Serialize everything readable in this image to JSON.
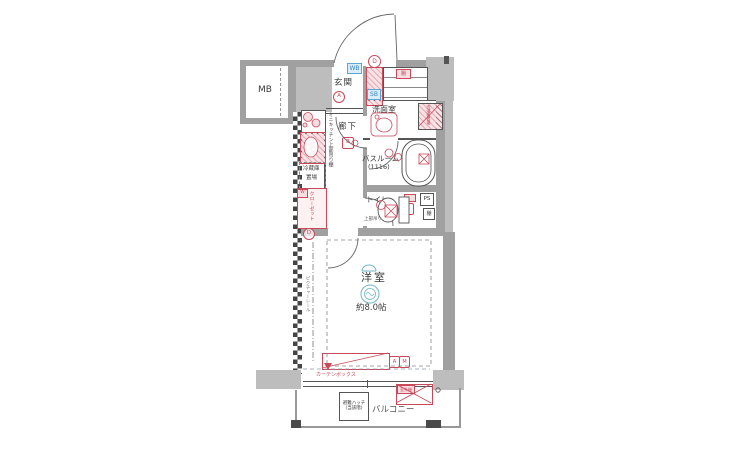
{
  "rooms": {
    "mb": "MB",
    "genkan": "玄関",
    "hallway": "廊下",
    "washroom": "洗面室",
    "bathroom": "バスルーム",
    "bathroom_size": "(1116)",
    "toilet": "トイレ",
    "western_room": "洋室",
    "western_room_size": "約8.0帖",
    "balcony": "バルコニー"
  },
  "labels": {
    "ps": "PS",
    "shelf": "棚",
    "cabinet_tag": "棚",
    "shoe_box": "SB",
    "entry_tag": "WB",
    "washer": "洗濯機置場",
    "toilet_shelf": "上部吊り棚",
    "kitchen_note": "ミニキッチン上部吊り棚",
    "kitchen_red": "キッチン",
    "fridge_1": "冷蔵庫",
    "fridge_2": "置場",
    "closet": "クローゼット",
    "closet_tag": "W",
    "picture_rail": "ピクチャーレール",
    "curtain_box": "カーテンボックス",
    "hatch_1": "避難ハッチ",
    "hatch_2": "(当該階)",
    "outdoor_unit": "室外機"
  },
  "marks": {
    "circle_d": "D",
    "circle_a": "A",
    "box_b": "B",
    "box_c": "C",
    "circle_d2": "D",
    "box_a": "A",
    "box_m": "M"
  },
  "colors": {
    "red": "#c9485a",
    "blue": "#5aa7d6",
    "teal": "#6fb5c4",
    "wall": "#a0a0a0"
  }
}
